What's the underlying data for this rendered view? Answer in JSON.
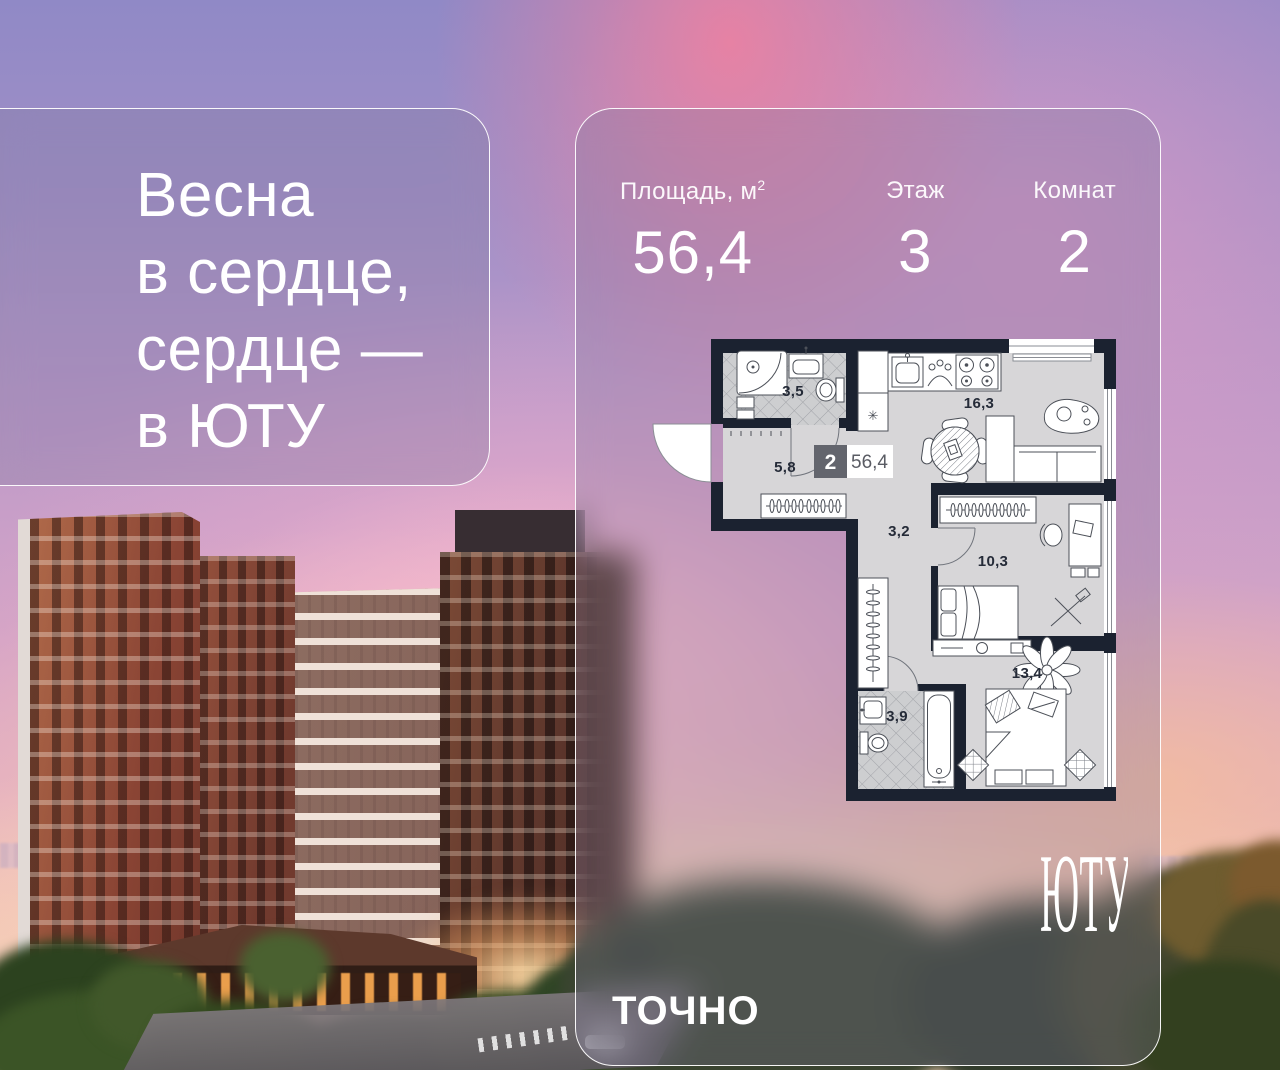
{
  "quote_card": {
    "lines": [
      "Весна",
      "в сердце,",
      "сердце —",
      "в ЮТУ"
    ]
  },
  "info_card": {
    "stats": [
      {
        "label": "Площадь, м",
        "label_sup": "2",
        "value": "56,4"
      },
      {
        "label": "Этаж",
        "label_sup": "",
        "value": "3"
      },
      {
        "label": "Комнат",
        "label_sup": "",
        "value": "2"
      }
    ],
    "floorplan": {
      "badge": {
        "rooms_count": "2",
        "total_area": "56,4"
      },
      "shaft_symbol": "✳",
      "rooms": [
        {
          "name": "bathroom-small",
          "area": "3,5"
        },
        {
          "name": "hallway",
          "area": "5,8"
        },
        {
          "name": "kitchen-living-room",
          "area": "16,3"
        },
        {
          "name": "corridor",
          "area": "3,2"
        },
        {
          "name": "bedroom-small",
          "area": "10,3"
        },
        {
          "name": "bathroom-large",
          "area": "3,9"
        },
        {
          "name": "bedroom-large",
          "area": "13,4"
        }
      ]
    },
    "brand_developer": "ТОЧНО",
    "brand_project": "ЮТУ"
  },
  "colors": {
    "plan_wall": "#1b2230",
    "plan_floor": "#d7d6d8",
    "tile": "#cdced0",
    "card_border": "#ffffff",
    "text": "#ffffff",
    "badge_square": "#63656d"
  }
}
